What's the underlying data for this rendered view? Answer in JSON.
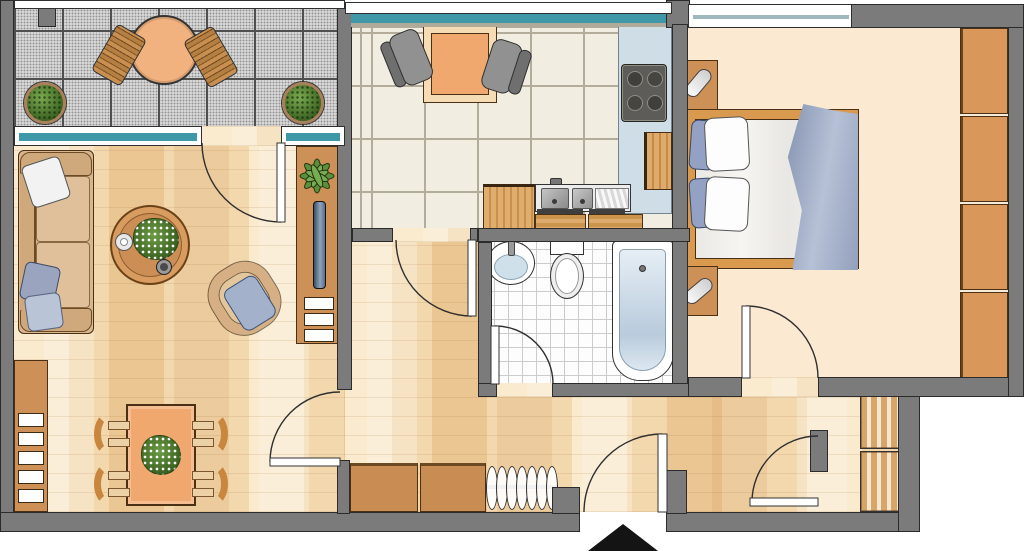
{
  "scene": {
    "type": "architectural floor plan",
    "view": "top-down 2D apartment plan",
    "visible_text": "none",
    "apartment": "2-room flat with balcony, kitchen, bathroom, bedroom, hallway and storage nook",
    "entrance_marker": "solid black triangle at the bottom entrance door"
  },
  "colors": {
    "wall": "#7b7b7b",
    "outline": "#2b2b2b",
    "woodEdge": "#4a3014",
    "parquetBase": "#f3d8ae",
    "kitchenTile": "#f1ede0",
    "kitchenGrout": "#b3ac9b",
    "bathTile": "#fdfdfd",
    "bathGrout": "#cccccc",
    "balconyTile": "#d7d7d7",
    "balconyGrout": "#4f4f4f",
    "bedroomFloor": "#fce9d2",
    "glass": "#3f98a8",
    "furnitureWood": "#cd9056",
    "furnitureWoodLight": "#dcab6d",
    "tableOrange": "#f0a86e",
    "sofaTan": "#d8b78f",
    "cushionBlue": "#9aa4bf",
    "counterBlue": "#cfdde6",
    "applianceGrey": "#5d5c58",
    "chairGrey": "#919191",
    "blanketBlue": "#8a97b6",
    "arrowBlack": "#141414"
  },
  "rooms": [
    {
      "id": "balcony",
      "floor": "grey stone tile grid",
      "furniture": [
        "round bistro table",
        "two slatted wooden chairs",
        "two potted shrubs"
      ]
    },
    {
      "id": "living-room",
      "floor": "wood parquet",
      "furniture": [
        "three-seat sofa with white and blue pillows",
        "round coffee table with bouquet, candle and bowl",
        "upholstered armchair with blue cushion",
        "sideboard with houseplant, TV and white shelves"
      ]
    },
    {
      "id": "dining-area",
      "floor": "wood parquet",
      "furniture": [
        "dining table with green centerpiece",
        "four curved-back chairs",
        "wall shelf unit with white shelves"
      ]
    },
    {
      "id": "kitchen",
      "floor": "cream ceramic tile",
      "furniture": [
        "square table",
        "two grey chairs",
        "double sink counter with base cabinets",
        "four-burner cooktop on blue counter",
        "tall wooden cabinet"
      ]
    },
    {
      "id": "bathroom",
      "floor": "small white tile",
      "furniture": [
        "washbasin",
        "toilet with cistern",
        "bathtub"
      ]
    },
    {
      "id": "bedroom",
      "floor": "beige carpet",
      "furniture": [
        "double bed with pillows and blue duvet",
        "two nightstands with reading lamps",
        "four-section wardrobe"
      ]
    },
    {
      "id": "hallway",
      "floor": "wood parquet",
      "furniture": [
        "two low cabinets",
        "coat rail with seven hangers"
      ]
    },
    {
      "id": "storage-nook",
      "floor": "wood parquet",
      "furniture": [
        "two slatted shelf units"
      ]
    }
  ],
  "doors": [
    {
      "id": "balcony-door",
      "between": [
        "living-room",
        "balcony"
      ]
    },
    {
      "id": "living-room-door",
      "between": [
        "hallway",
        "living-room"
      ]
    },
    {
      "id": "kitchen-door",
      "between": [
        "hallway",
        "kitchen"
      ]
    },
    {
      "id": "bathroom-door",
      "between": [
        "hallway",
        "bathroom"
      ]
    },
    {
      "id": "bedroom-door",
      "between": [
        "hallway",
        "bedroom"
      ]
    },
    {
      "id": "entrance-door",
      "between": [
        "outside",
        "hallway"
      ]
    },
    {
      "id": "storage-door",
      "between": [
        "hallway",
        "storage-nook"
      ]
    }
  ],
  "windows": [
    {
      "id": "balcony-window",
      "wall": "north, living room to balcony, teal glazing"
    },
    {
      "id": "kitchen-window",
      "wall": "north kitchen, teal glazing"
    },
    {
      "id": "bedroom-window",
      "wall": "north bedroom"
    }
  ]
}
